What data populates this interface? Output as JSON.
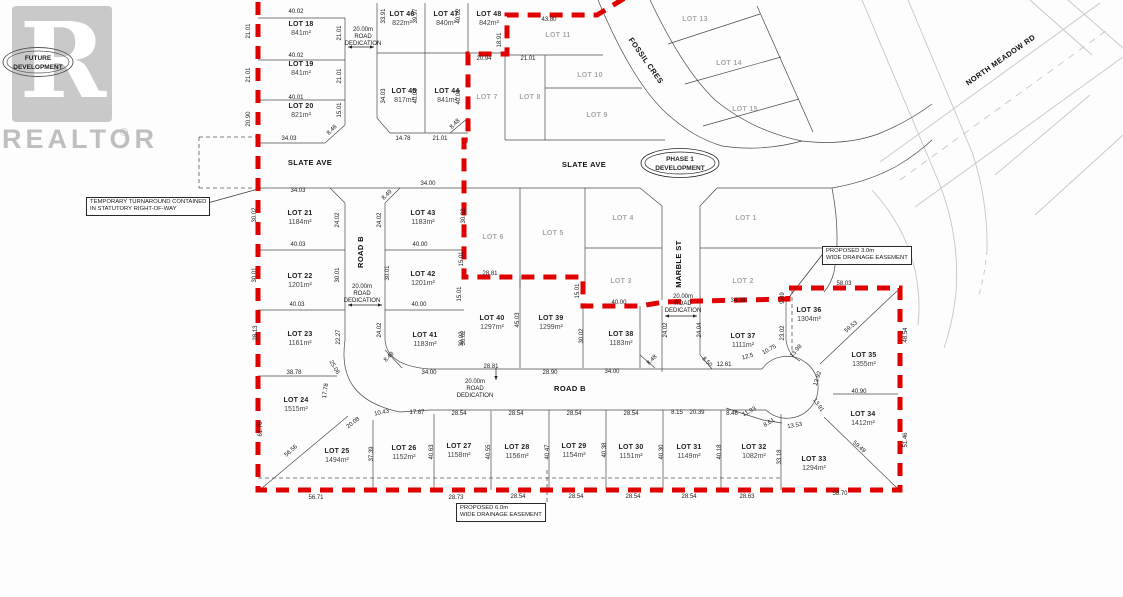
{
  "watermark": {
    "brand": "REALTOR",
    "reg": "®",
    "logo_letter": "R",
    "stamp_line1": "FUTURE",
    "stamp_line2": "DEVELOPMENT"
  },
  "phase_badge": {
    "line1": "PHASE 1",
    "line2": "DEVELOPMENT"
  },
  "notes": {
    "turnaround": {
      "line1": "TEMPORARY TURNAROUND CONTAINED",
      "line2": "IN STATUTORY RIGHT-OF-WAY"
    },
    "easement3": {
      "line1": "PROPOSED 3.0m",
      "line2": "WIDE DRAINAGE EASEMENT"
    },
    "easement6": {
      "line1": "PROPOSED 6.0m",
      "line2": "WIDE DRAINAGE EASEMENT"
    }
  },
  "colors": {
    "boundary_red": "#e00000",
    "grid_dark": "#4a4a4a",
    "bg_light": "#c6c6c6",
    "faint_text": "#a9a9a9"
  },
  "map": {
    "labels": [
      {
        "t": "SLATE AVE",
        "x": 310,
        "y": 165,
        "c": "street"
      },
      {
        "t": "SLATE AVE",
        "x": 584,
        "y": 167,
        "c": "street"
      },
      {
        "t": "ROAD B",
        "x": 363,
        "y": 252,
        "r": -90,
        "c": "street"
      },
      {
        "t": "ROAD B",
        "x": 570,
        "y": 391,
        "c": "street"
      },
      {
        "t": "MARBLE ST",
        "x": 681,
        "y": 264,
        "r": -90,
        "c": "street"
      },
      {
        "t": "FOSSIL CRES",
        "x": 644,
        "y": 62,
        "r": 55,
        "c": "street"
      },
      {
        "t": "NORTH MEADOW RD",
        "x": 1002,
        "y": 62,
        "r": -35,
        "c": "street"
      },
      {
        "t": "LOT 1",
        "x": 746,
        "y": 220,
        "c": "faint"
      },
      {
        "t": "LOT 2",
        "x": 743,
        "y": 283,
        "c": "faint"
      },
      {
        "t": "LOT 3",
        "x": 621,
        "y": 283,
        "c": "faint"
      },
      {
        "t": "LOT 4",
        "x": 623,
        "y": 220,
        "c": "faint"
      },
      {
        "t": "LOT 5",
        "x": 553,
        "y": 235,
        "c": "faint"
      },
      {
        "t": "LOT 6",
        "x": 493,
        "y": 239,
        "c": "faint"
      },
      {
        "t": "LOT 7",
        "x": 487,
        "y": 99,
        "c": "faint"
      },
      {
        "t": "LOT 8",
        "x": 530,
        "y": 99,
        "c": "faint"
      },
      {
        "t": "LOT 9",
        "x": 597,
        "y": 117,
        "c": "faint"
      },
      {
        "t": "LOT 10",
        "x": 590,
        "y": 77,
        "c": "faint"
      },
      {
        "t": "LOT 11",
        "x": 558,
        "y": 37,
        "c": "faint"
      },
      {
        "t": "LOT 13",
        "x": 695,
        "y": 21,
        "c": "faint"
      },
      {
        "t": "LOT 14",
        "x": 729,
        "y": 65,
        "c": "faint"
      },
      {
        "t": "LOT 15",
        "x": 745,
        "y": 111,
        "c": "faint"
      },
      {
        "t": "LOT 18",
        "x": 301,
        "y": 26,
        "c": "lot"
      },
      {
        "t": "841m²",
        "x": 301,
        "y": 35,
        "c": "area"
      },
      {
        "t": "LOT 19",
        "x": 301,
        "y": 66,
        "c": "lot"
      },
      {
        "t": "841m²",
        "x": 301,
        "y": 75,
        "c": "area"
      },
      {
        "t": "LOT 20",
        "x": 301,
        "y": 108,
        "c": "lot"
      },
      {
        "t": "821m²",
        "x": 301,
        "y": 117,
        "c": "area"
      },
      {
        "t": "LOT 46",
        "x": 402,
        "y": 16,
        "c": "lot"
      },
      {
        "t": "822m²",
        "x": 402,
        "y": 25,
        "c": "area"
      },
      {
        "t": "LOT 47",
        "x": 446,
        "y": 16,
        "c": "lot"
      },
      {
        "t": "840m²",
        "x": 446,
        "y": 25,
        "c": "area"
      },
      {
        "t": "LOT 48",
        "x": 489,
        "y": 16,
        "c": "lot"
      },
      {
        "t": "842m²",
        "x": 489,
        "y": 25,
        "c": "area"
      },
      {
        "t": "LOT 45",
        "x": 404,
        "y": 93,
        "c": "lot"
      },
      {
        "t": "817m²",
        "x": 404,
        "y": 102,
        "c": "area"
      },
      {
        "t": "LOT 44",
        "x": 447,
        "y": 93,
        "c": "lot"
      },
      {
        "t": "841m²",
        "x": 447,
        "y": 102,
        "c": "area"
      },
      {
        "t": "LOT 21",
        "x": 300,
        "y": 215,
        "c": "lot"
      },
      {
        "t": "1184m²",
        "x": 300,
        "y": 224,
        "c": "area"
      },
      {
        "t": "LOT 43",
        "x": 423,
        "y": 215,
        "c": "lot"
      },
      {
        "t": "1183m²",
        "x": 423,
        "y": 224,
        "c": "area"
      },
      {
        "t": "LOT 22",
        "x": 300,
        "y": 278,
        "c": "lot"
      },
      {
        "t": "1201m²",
        "x": 300,
        "y": 287,
        "c": "area"
      },
      {
        "t": "LOT 42",
        "x": 423,
        "y": 276,
        "c": "lot"
      },
      {
        "t": "1201m²",
        "x": 423,
        "y": 285,
        "c": "area"
      },
      {
        "t": "LOT 23",
        "x": 300,
        "y": 336,
        "c": "lot"
      },
      {
        "t": "1161m²",
        "x": 300,
        "y": 345,
        "c": "area"
      },
      {
        "t": "LOT 41",
        "x": 425,
        "y": 337,
        "c": "lot"
      },
      {
        "t": "1183m²",
        "x": 425,
        "y": 346,
        "c": "area"
      },
      {
        "t": "LOT 24",
        "x": 296,
        "y": 402,
        "c": "lot"
      },
      {
        "t": "1515m²",
        "x": 296,
        "y": 411,
        "c": "area"
      },
      {
        "t": "LOT 25",
        "x": 337,
        "y": 453,
        "c": "lot"
      },
      {
        "t": "1494m²",
        "x": 337,
        "y": 462,
        "c": "area"
      },
      {
        "t": "LOT 26",
        "x": 404,
        "y": 450,
        "c": "lot"
      },
      {
        "t": "1152m²",
        "x": 404,
        "y": 459,
        "c": "area"
      },
      {
        "t": "LOT 27",
        "x": 459,
        "y": 448,
        "c": "lot"
      },
      {
        "t": "1158m²",
        "x": 459,
        "y": 457,
        "c": "area"
      },
      {
        "t": "LOT 28",
        "x": 517,
        "y": 449,
        "c": "lot"
      },
      {
        "t": "1156m²",
        "x": 517,
        "y": 458,
        "c": "area"
      },
      {
        "t": "LOT 29",
        "x": 574,
        "y": 448,
        "c": "lot"
      },
      {
        "t": "1154m²",
        "x": 574,
        "y": 457,
        "c": "area"
      },
      {
        "t": "LOT 30",
        "x": 631,
        "y": 449,
        "c": "lot"
      },
      {
        "t": "1151m²",
        "x": 631,
        "y": 458,
        "c": "area"
      },
      {
        "t": "LOT 31",
        "x": 689,
        "y": 449,
        "c": "lot"
      },
      {
        "t": "1149m²",
        "x": 689,
        "y": 458,
        "c": "area"
      },
      {
        "t": "LOT 32",
        "x": 754,
        "y": 449,
        "c": "lot"
      },
      {
        "t": "1082m²",
        "x": 754,
        "y": 458,
        "c": "area"
      },
      {
        "t": "LOT 33",
        "x": 814,
        "y": 461,
        "c": "lot"
      },
      {
        "t": "1294m²",
        "x": 814,
        "y": 470,
        "c": "area"
      },
      {
        "t": "LOT 34",
        "x": 863,
        "y": 416,
        "c": "lot"
      },
      {
        "t": "1412m²",
        "x": 863,
        "y": 425,
        "c": "area"
      },
      {
        "t": "LOT 35",
        "x": 864,
        "y": 357,
        "c": "lot"
      },
      {
        "t": "1355m²",
        "x": 864,
        "y": 366,
        "c": "area"
      },
      {
        "t": "LOT 36",
        "x": 809,
        "y": 312,
        "c": "lot"
      },
      {
        "t": "1304m²",
        "x": 809,
        "y": 321,
        "c": "area"
      },
      {
        "t": "LOT 37",
        "x": 743,
        "y": 338,
        "c": "lot"
      },
      {
        "t": "1111m²",
        "x": 743,
        "y": 347,
        "c": "area"
      },
      {
        "t": "LOT 38",
        "x": 621,
        "y": 336,
        "c": "lot"
      },
      {
        "t": "1183m²",
        "x": 621,
        "y": 345,
        "c": "area"
      },
      {
        "t": "LOT 39",
        "x": 551,
        "y": 320,
        "c": "lot"
      },
      {
        "t": "1299m²",
        "x": 551,
        "y": 329,
        "c": "area"
      },
      {
        "t": "LOT 40",
        "x": 492,
        "y": 320,
        "c": "lot"
      },
      {
        "t": "1297m²",
        "x": 492,
        "y": 329,
        "c": "area"
      },
      {
        "t": "40.02",
        "x": 296,
        "y": 13
      },
      {
        "t": "21.01",
        "x": 250,
        "y": 31,
        "r": -90
      },
      {
        "t": "21.01",
        "x": 341,
        "y": 33,
        "r": -90
      },
      {
        "t": "40.02",
        "x": 296,
        "y": 57
      },
      {
        "t": "21.01",
        "x": 250,
        "y": 75,
        "r": -90
      },
      {
        "t": "21.01",
        "x": 341,
        "y": 76,
        "r": -90
      },
      {
        "t": "40.01",
        "x": 296,
        "y": 99
      },
      {
        "t": "20.90",
        "x": 250,
        "y": 119,
        "r": -90
      },
      {
        "t": "15.01",
        "x": 341,
        "y": 110,
        "r": -90
      },
      {
        "t": "8.46",
        "x": 333,
        "y": 131,
        "r": -45
      },
      {
        "t": "34.03",
        "x": 289,
        "y": 140
      },
      {
        "t": "33.91",
        "x": 385,
        "y": 16,
        "r": -90
      },
      {
        "t": "39.97",
        "x": 417,
        "y": 16,
        "r": -90
      },
      {
        "t": "40.02",
        "x": 460,
        "y": 16,
        "r": -90
      },
      {
        "t": "43.80",
        "x": 549,
        "y": 21
      },
      {
        "t": "18.91",
        "x": 501,
        "y": 40,
        "r": -90
      },
      {
        "t": "20.94",
        "x": 484,
        "y": 60
      },
      {
        "t": "21.01",
        "x": 528,
        "y": 60
      },
      {
        "t": "34.03",
        "x": 385,
        "y": 96,
        "r": -90
      },
      {
        "t": "40.03",
        "x": 417,
        "y": 96,
        "r": -90
      },
      {
        "t": "40.03",
        "x": 460,
        "y": 97,
        "r": -90
      },
      {
        "t": "8.48",
        "x": 456,
        "y": 125,
        "r": -45
      },
      {
        "t": "14.78",
        "x": 403,
        "y": 140
      },
      {
        "t": "21.01",
        "x": 440,
        "y": 140
      },
      {
        "t": "34.03",
        "x": 298,
        "y": 192
      },
      {
        "t": "34.00",
        "x": 428,
        "y": 185
      },
      {
        "t": "8.49",
        "x": 388,
        "y": 196,
        "r": -45
      },
      {
        "t": "30.02",
        "x": 256,
        "y": 215,
        "r": -90
      },
      {
        "t": "24.02",
        "x": 339,
        "y": 220,
        "r": -90
      },
      {
        "t": "24.02",
        "x": 381,
        "y": 220,
        "r": -90
      },
      {
        "t": "30.02",
        "x": 465,
        "y": 216,
        "r": -90
      },
      {
        "t": "40.03",
        "x": 298,
        "y": 246
      },
      {
        "t": "40.00",
        "x": 420,
        "y": 246
      },
      {
        "t": "30.01",
        "x": 256,
        "y": 275,
        "r": -90
      },
      {
        "t": "30.01",
        "x": 339,
        "y": 275,
        "r": -90
      },
      {
        "t": "30.01",
        "x": 389,
        "y": 273,
        "r": -90
      },
      {
        "t": "15.01",
        "x": 463,
        "y": 259,
        "r": -90
      },
      {
        "t": "15.01",
        "x": 461,
        "y": 294,
        "r": -90
      },
      {
        "t": "28.81",
        "x": 490,
        "y": 275
      },
      {
        "t": "40.03",
        "x": 297,
        "y": 306
      },
      {
        "t": "40.00",
        "x": 419,
        "y": 306
      },
      {
        "t": "28.13",
        "x": 257,
        "y": 333,
        "r": -90
      },
      {
        "t": "22.27",
        "x": 340,
        "y": 337,
        "r": -90
      },
      {
        "t": "24.02",
        "x": 381,
        "y": 330,
        "r": -90
      },
      {
        "t": "30.02",
        "x": 465,
        "y": 338,
        "r": -90
      },
      {
        "t": "38.78",
        "x": 294,
        "y": 374
      },
      {
        "t": "34.00",
        "x": 429,
        "y": 374
      },
      {
        "t": "8.49",
        "x": 390,
        "y": 358,
        "r": -45
      },
      {
        "t": "25.06",
        "x": 333,
        "y": 368,
        "r": 60
      },
      {
        "t": "17.78",
        "x": 327,
        "y": 391,
        "r": -82
      },
      {
        "t": "20.08",
        "x": 354,
        "y": 424,
        "r": -38
      },
      {
        "t": "61.76",
        "x": 262,
        "y": 429,
        "r": -90
      },
      {
        "t": "56.56",
        "x": 292,
        "y": 452,
        "r": -42
      },
      {
        "t": "37.39",
        "x": 373,
        "y": 454,
        "r": -90
      },
      {
        "t": "10.43",
        "x": 382,
        "y": 414,
        "r": -12
      },
      {
        "t": "17.67",
        "x": 417,
        "y": 414
      },
      {
        "t": "40.63",
        "x": 433,
        "y": 452,
        "r": -90
      },
      {
        "t": "40.55",
        "x": 490,
        "y": 452,
        "r": -90
      },
      {
        "t": "40.47",
        "x": 549,
        "y": 452,
        "r": -90
      },
      {
        "t": "40.38",
        "x": 606,
        "y": 450,
        "r": -90
      },
      {
        "t": "40.30",
        "x": 663,
        "y": 452,
        "r": -90
      },
      {
        "t": "40.18",
        "x": 721,
        "y": 452,
        "r": -90
      },
      {
        "t": "33.18",
        "x": 781,
        "y": 457,
        "r": -90
      },
      {
        "t": "28.54",
        "x": 459,
        "y": 415
      },
      {
        "t": "28.54",
        "x": 516,
        "y": 415
      },
      {
        "t": "28.54",
        "x": 574,
        "y": 415
      },
      {
        "t": "28.54",
        "x": 631,
        "y": 415
      },
      {
        "t": "8.15",
        "x": 677,
        "y": 414
      },
      {
        "t": "20.39",
        "x": 697,
        "y": 414
      },
      {
        "t": "8.46",
        "x": 732,
        "y": 415
      },
      {
        "t": "11.93",
        "x": 750,
        "y": 413,
        "r": -28
      },
      {
        "t": "8.61",
        "x": 770,
        "y": 424,
        "r": -32
      },
      {
        "t": "13.53",
        "x": 795,
        "y": 427,
        "r": -10
      },
      {
        "t": "45.03",
        "x": 519,
        "y": 320,
        "r": -90
      },
      {
        "t": "30.02",
        "x": 463,
        "y": 339,
        "r": -90
      },
      {
        "t": "30.02",
        "x": 583,
        "y": 336,
        "r": -90
      },
      {
        "t": "15.01",
        "x": 579,
        "y": 291,
        "r": -90
      },
      {
        "t": "28.81",
        "x": 491,
        "y": 368
      },
      {
        "t": "28.90",
        "x": 550,
        "y": 374
      },
      {
        "t": "34.00",
        "x": 612,
        "y": 373
      },
      {
        "t": "40.00",
        "x": 619,
        "y": 304
      },
      {
        "t": "24.02",
        "x": 667,
        "y": 330,
        "r": -90
      },
      {
        "t": "24.04",
        "x": 701,
        "y": 330,
        "r": -90
      },
      {
        "t": "8.48",
        "x": 653,
        "y": 361,
        "r": -45
      },
      {
        "t": "8.50",
        "x": 706,
        "y": 363,
        "r": 45
      },
      {
        "t": "12.61",
        "x": 724,
        "y": 366
      },
      {
        "t": "34.99",
        "x": 738,
        "y": 302
      },
      {
        "t": "9.89",
        "x": 784,
        "y": 298,
        "r": -90
      },
      {
        "t": "58.03",
        "x": 844,
        "y": 285
      },
      {
        "t": "23.02",
        "x": 784,
        "y": 333,
        "r": -90
      },
      {
        "t": "13.98",
        "x": 797,
        "y": 352,
        "r": -48
      },
      {
        "t": "10.75",
        "x": 770,
        "y": 351,
        "r": -28
      },
      {
        "t": "12.5",
        "x": 748,
        "y": 358,
        "r": -15
      },
      {
        "t": "59.53",
        "x": 852,
        "y": 328,
        "r": -40
      },
      {
        "t": "48.54",
        "x": 907,
        "y": 335,
        "r": -90
      },
      {
        "t": "13.92",
        "x": 819,
        "y": 379,
        "r": -72
      },
      {
        "t": "40.90",
        "x": 859,
        "y": 393
      },
      {
        "t": "13.91",
        "x": 817,
        "y": 406,
        "r": 55
      },
      {
        "t": "59.49",
        "x": 858,
        "y": 448,
        "r": 42
      },
      {
        "t": "51.46",
        "x": 907,
        "y": 440,
        "r": -90
      },
      {
        "t": "56.71",
        "x": 316,
        "y": 499
      },
      {
        "t": "28.73",
        "x": 456,
        "y": 499
      },
      {
        "t": "28.54",
        "x": 518,
        "y": 498
      },
      {
        "t": "28.54",
        "x": 576,
        "y": 498
      },
      {
        "t": "28.54",
        "x": 633,
        "y": 498
      },
      {
        "t": "28.54",
        "x": 689,
        "y": 498
      },
      {
        "t": "28.63",
        "x": 747,
        "y": 498
      },
      {
        "t": "58.70",
        "x": 840,
        "y": 495
      },
      {
        "t": "20.00m",
        "x": 363,
        "y": 31
      },
      {
        "t": "ROAD",
        "x": 363,
        "y": 38
      },
      {
        "t": "DEDICATION",
        "x": 363,
        "y": 45
      },
      {
        "t": "20.00m",
        "x": 362,
        "y": 288
      },
      {
        "t": "ROAD",
        "x": 362,
        "y": 295
      },
      {
        "t": "DEDICATION",
        "x": 362,
        "y": 302
      },
      {
        "t": "20.00m",
        "x": 475,
        "y": 383
      },
      {
        "t": "ROAD",
        "x": 475,
        "y": 390
      },
      {
        "t": "DEDICATION",
        "x": 475,
        "y": 397
      },
      {
        "t": "20.00m",
        "x": 683,
        "y": 298
      },
      {
        "t": "ROAD",
        "x": 683,
        "y": 305
      },
      {
        "t": "DEDICATION",
        "x": 683,
        "y": 312
      }
    ]
  }
}
